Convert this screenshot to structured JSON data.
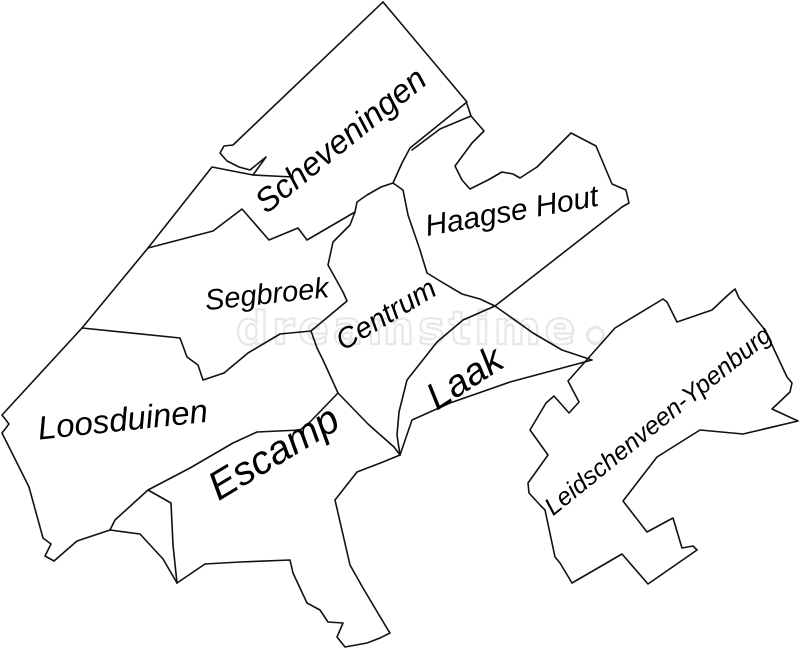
{
  "map": {
    "background_color": "#ffffff",
    "line_color": "#111111",
    "districts": [
      {
        "id": "scheveningen",
        "label": "Scheveningen"
      },
      {
        "id": "haagse-hout",
        "label": "Haagse Hout"
      },
      {
        "id": "segbroek",
        "label": "Segbroek"
      },
      {
        "id": "centrum",
        "label": "Centrum"
      },
      {
        "id": "laak",
        "label": "Laak"
      },
      {
        "id": "loosduinen",
        "label": "Loosduinen"
      },
      {
        "id": "escamp",
        "label": "Escamp"
      },
      {
        "id": "leidschenveen-ypenburg",
        "label": "Leidschenveen-Ypenburg"
      }
    ],
    "boundaries": [
      {
        "name": "coast-scheveningen-harbor",
        "path": "M383,2 L233,145 L224,146 L220,153 L227,161 L239,167 L250,170 L266,157 L253,175 L212,167 L148,248 L82,328"
      },
      {
        "name": "harbor-quay",
        "path": "M253,175 L293,177"
      },
      {
        "name": "scheveningen-east-edge",
        "path": "M383,2 L467,102 L410,148 L402,163 L393,183 L381,187 L367,195 L357,202 L355,212"
      },
      {
        "name": "scheveningen-segbroek-boundary",
        "path": "M355,212 L307,240 L298,228 L269,240 L242,209 L213,231 L148,248"
      },
      {
        "name": "segbroek-centrum-boundary",
        "path": "M355,212 L350,225 L333,242 L328,265 L343,292 L347,301 L311,331"
      },
      {
        "name": "segbroek-south-boundary",
        "path": "M311,331 L280,334 L248,353 L224,373"
      },
      {
        "name": "loosduinen-northeast-boundary",
        "path": "M82,328 L180,338 L187,357 L198,365 L203,380 L224,373"
      },
      {
        "name": "loosduinen-west-south-boundary",
        "path": "M82,328 L2,415 L9,424 L2,433 L29,487 L43,538 L51,544 L45,556 L54,561 L77,541 L110,530 L140,534 L163,559 L177,583"
      },
      {
        "name": "loosduinen-east-notch",
        "path": "M110,530 L115,520 L148,490 L171,503 L173,545 L177,583"
      },
      {
        "name": "loosduinen-escamp-boundary",
        "path": "M338,393 L310,422 L300,430 L257,432 L233,443 L190,468 L148,490"
      },
      {
        "name": "centrum-west-boundary",
        "path": "M311,331 L317,348 L323,360 L338,393"
      },
      {
        "name": "centrum-east-boundary",
        "path": "M393,183 L403,190 L408,215 L420,250 L427,273 L440,281 L462,294 L480,299 L495,306"
      },
      {
        "name": "haagse-hout-outline",
        "path": "M467,104 L471,116 L484,131 L472,143 L455,166 L462,180 L470,189 L488,180 L502,172 L513,174 L520,178 L537,167 L571,133 L596,146 L612,184 L626,190 L629,203 L622,207 L495,306"
      },
      {
        "name": "haagse-hout-inner-claw",
        "path": "M471,116 L440,129 L412,150"
      },
      {
        "name": "laak-outline",
        "path": "M495,306 L533,333 L562,350 L592,360 L510,382 L450,403 L412,420 L400,455 L397,435 L399,412 L407,380 L437,342 L463,320 Z"
      },
      {
        "name": "centrum-escamp-boundary",
        "path": "M338,393 L368,424 L394,447 L400,455"
      },
      {
        "name": "escamp-east-tail-boundary",
        "path": "M400,455 L383,462 L357,472 L335,500 L350,565 L363,588 L388,630 L390,633 L380,638 L367,643 L345,647 L337,637 L343,623 L328,622 L320,610 L307,603 L293,573 L290,560 L240,562 L205,564 L177,583"
      },
      {
        "name": "leidschenveen-ypenburg-outline",
        "path": "M728,295 L735,289 L739,298 L765,330 L787,377 L792,383 L790,392 L772,409 L798,421 L743,434 L700,430 L657,457 L623,501 L647,532 L673,518 L682,548 L693,546 L697,550 L648,584 L622,554 L572,583 L560,563 L555,557 L545,510 L540,505 L529,493 L528,483 L548,455 L530,430 L546,403 L554,396 L569,413 L579,402 L568,381 L615,328 L663,299 L667,302 L677,322 L712,310 Z"
      }
    ]
  },
  "watermark": {
    "text": "dreamstime",
    "color": "#e7e7e7"
  }
}
